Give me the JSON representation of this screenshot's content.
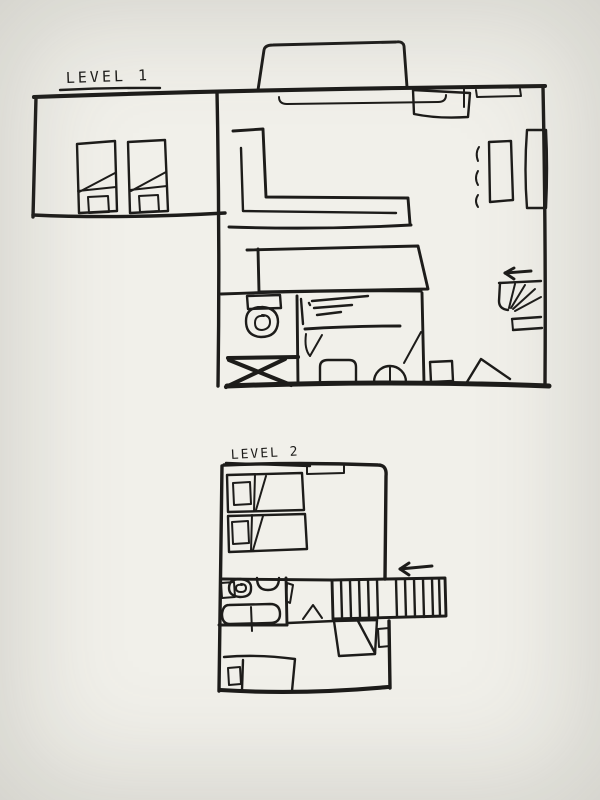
{
  "canvas": {
    "background": "#f1f0ea",
    "ink": "#1d1c1a",
    "style": "hand-drawn floor plan sketch, black marker on off-white paper"
  },
  "levels": [
    {
      "id": "level-1",
      "label": "LEVEL 1",
      "features": [
        "left bedroom annex with two single beds (pillows and folded-blanket diagonals)",
        "entry porch bump on top wall",
        "window sills below top wall",
        "corner sofa (L-shaped)",
        "long table / counter",
        "washing machine (circle in square)",
        "kitchen counter with hatch marks",
        "crossed-out box (shower)",
        "door leaves and swing wedges on bottom wall",
        "wardrobe and desk with three chair dashes on right wall",
        "winder staircase in bottom-right corner",
        "direction arrow pointing left above stairs"
      ]
    },
    {
      "id": "level-2",
      "label": "LEVEL 2",
      "features": [
        "two horizontal beds with pillows at top-left",
        "window notch on top wall",
        "bathroom with toilet, sink and bathtub",
        "bathroom door leaf",
        "door swing wedge in corridor",
        "straight staircase with treads extending past right wall",
        "direction arrow pointing left above stairs",
        "landing with diagonal below stairs and small door",
        "bed with pillow at bottom-left"
      ]
    }
  ]
}
